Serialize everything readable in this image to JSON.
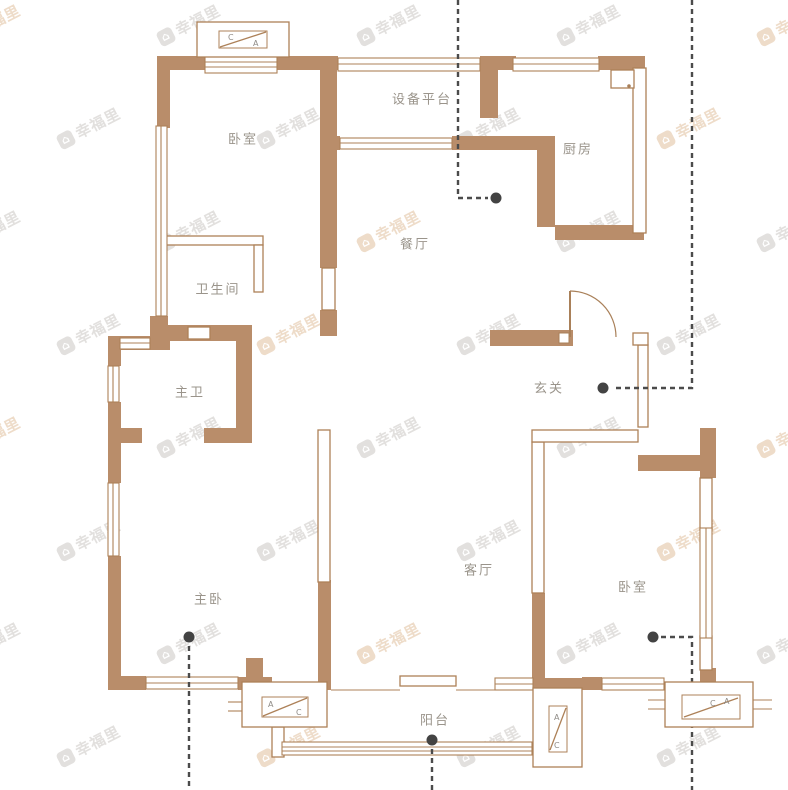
{
  "plan_title": "户型图",
  "watermark": {
    "text": "幸福里",
    "gray": "#e2e0de",
    "tan": "#eedcc9"
  },
  "palette": {
    "wall": "#b98d6a",
    "wall_outline": "#ad8158",
    "dash_line": "#4b4b4b",
    "label": "#9a948b"
  },
  "rooms": [
    {
      "name": "卧室"
    },
    {
      "name": "设备平台"
    },
    {
      "name": "厨房"
    },
    {
      "name": "餐厅"
    },
    {
      "name": "卫生间"
    },
    {
      "name": "主卫"
    },
    {
      "name": "玄关"
    },
    {
      "name": "主卧"
    },
    {
      "name": "客厅"
    },
    {
      "name": "卧室"
    },
    {
      "name": "阳台"
    }
  ],
  "ac_units": [
    {
      "l1": "C",
      "l2": "A"
    },
    {
      "l1": "A",
      "l2": "C"
    },
    {
      "l1": "A",
      "l2": "C"
    },
    {
      "l1": "C",
      "l2": "A"
    }
  ]
}
